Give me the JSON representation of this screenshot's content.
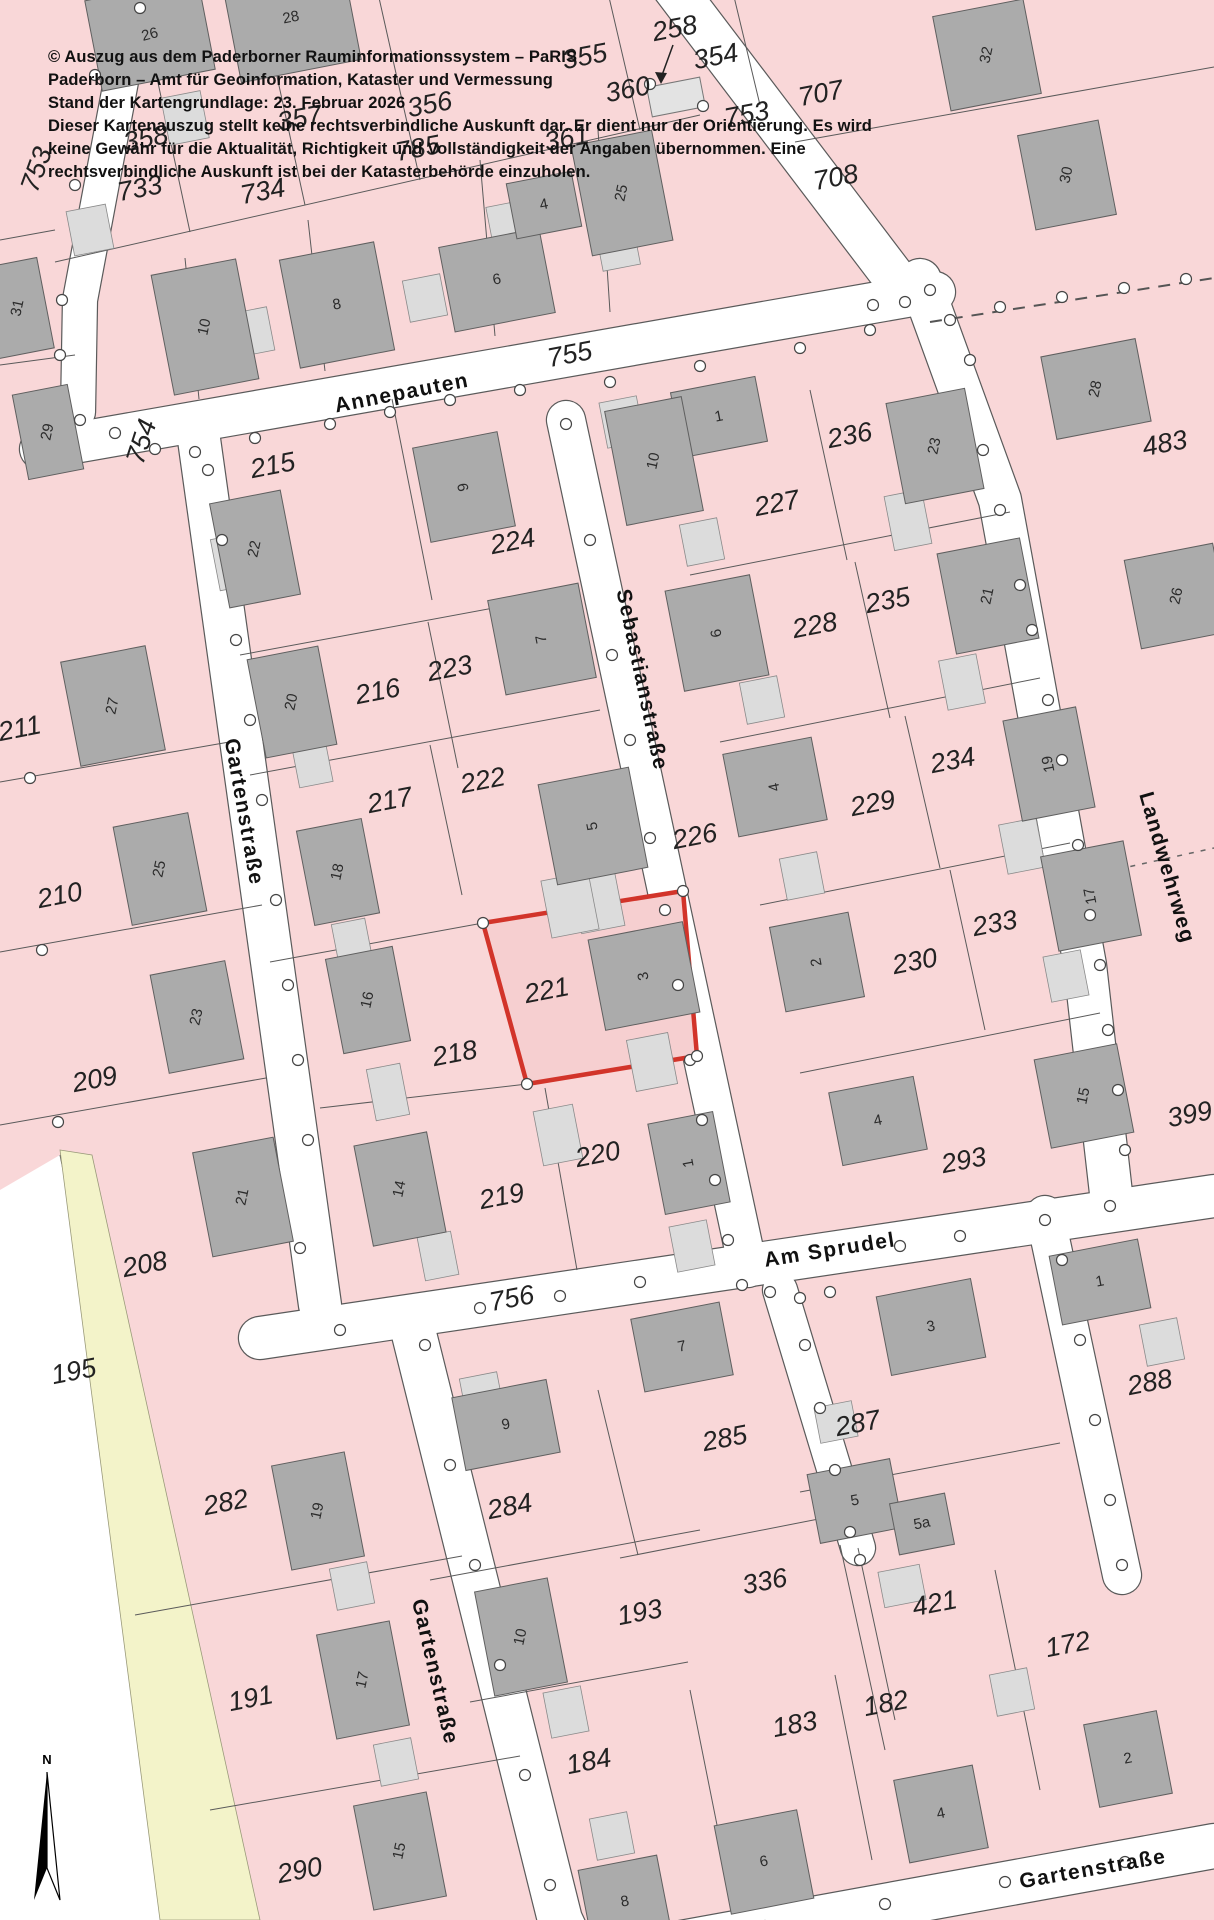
{
  "header": {
    "lines": [
      "© Auszug aus dem Paderborner Rauminformationssystem – PaRIS",
      "Paderborn – Amt für Geoinformation, Kataster und Vermessung",
      "Stand der Kartengrundlage: 23. Februar 2026",
      "Dieser Kartenauszug stellt keine rechtsverbindliche Auskunft dar. Er dient nur der Orientierung. Es wird",
      "keine Gewähr für die Aktualität, Richtigkeit und Vollständigkeit der Angaben übernommen. Eine",
      "rechtsverbindliche Auskunft ist bei der Katasterbehörde einzuholen."
    ]
  },
  "map": {
    "colors": {
      "parcel_fill": "#f9d7d8",
      "highlight_fill": "#f6cfd0",
      "highlight_stroke": "#d2342a",
      "building_fill": "#ababab",
      "annex_fill": "#dcdcdc",
      "street_fill": "#ffffff",
      "green_strip": "#f3f3c9",
      "line": "#5a5a5a"
    },
    "highlight": {
      "parcel": "221"
    },
    "north_label": "N",
    "streets": [
      {
        "name": "Annepauten",
        "x": 402,
        "y": 394,
        "rot": -11
      },
      {
        "name": "Sebastianstraße",
        "x": 641,
        "y": 680,
        "rot": 78
      },
      {
        "name": "Gartenstraße",
        "x": 243,
        "y": 812,
        "rot": 80
      },
      {
        "name": "Landwehrweg",
        "x": 1166,
        "y": 868,
        "rot": 74
      },
      {
        "name": "Am Sprudel",
        "x": 830,
        "y": 1251,
        "rot": -9
      },
      {
        "name": "Gartenstraße",
        "x": 434,
        "y": 1672,
        "rot": 77
      },
      {
        "name": "Gartenstraße",
        "x": 1093,
        "y": 1870,
        "rot": -10
      }
    ],
    "parcels": [
      {
        "n": "358",
        "x": 146,
        "y": 140
      },
      {
        "n": "357",
        "x": 300,
        "y": 120
      },
      {
        "n": "356",
        "x": 430,
        "y": 106
      },
      {
        "n": "355",
        "x": 585,
        "y": 58
      },
      {
        "n": "354",
        "x": 716,
        "y": 58
      },
      {
        "n": "258",
        "x": 675,
        "y": 30
      },
      {
        "n": "360",
        "x": 628,
        "y": 91
      },
      {
        "n": "361",
        "x": 567,
        "y": 140
      },
      {
        "n": "785",
        "x": 418,
        "y": 150
      },
      {
        "n": "733",
        "x": 140,
        "y": 190
      },
      {
        "n": "734",
        "x": 263,
        "y": 193
      },
      {
        "n": "707",
        "x": 821,
        "y": 95
      },
      {
        "n": "708",
        "x": 836,
        "y": 179
      },
      {
        "n": "753",
        "x": 747,
        "y": 116
      },
      {
        "n": "753",
        "x": 38,
        "y": 170,
        "rot": -70
      },
      {
        "n": "483",
        "x": 1165,
        "y": 445
      },
      {
        "n": "755",
        "x": 570,
        "y": 356
      },
      {
        "n": "236",
        "x": 850,
        "y": 437
      },
      {
        "n": "227",
        "x": 777,
        "y": 505
      },
      {
        "n": "215",
        "x": 273,
        "y": 467
      },
      {
        "n": "224",
        "x": 513,
        "y": 543
      },
      {
        "n": "754",
        "x": 143,
        "y": 442,
        "rot": -72
      },
      {
        "n": "216",
        "x": 378,
        "y": 693
      },
      {
        "n": "223",
        "x": 450,
        "y": 670
      },
      {
        "n": "222",
        "x": 483,
        "y": 782
      },
      {
        "n": "217",
        "x": 390,
        "y": 802
      },
      {
        "n": "226",
        "x": 695,
        "y": 838
      },
      {
        "n": "228",
        "x": 815,
        "y": 627
      },
      {
        "n": "235",
        "x": 888,
        "y": 602
      },
      {
        "n": "234",
        "x": 953,
        "y": 762
      },
      {
        "n": "229",
        "x": 873,
        "y": 805
      },
      {
        "n": "233",
        "x": 995,
        "y": 925
      },
      {
        "n": "230",
        "x": 915,
        "y": 963
      },
      {
        "n": "211",
        "x": 20,
        "y": 730
      },
      {
        "n": "210",
        "x": 60,
        "y": 897
      },
      {
        "n": "209",
        "x": 95,
        "y": 1081
      },
      {
        "n": "208",
        "x": 145,
        "y": 1266
      },
      {
        "n": "195",
        "x": 74,
        "y": 1373
      },
      {
        "n": "218",
        "x": 455,
        "y": 1055
      },
      {
        "n": "221",
        "x": 547,
        "y": 992
      },
      {
        "n": "219",
        "x": 502,
        "y": 1198
      },
      {
        "n": "220",
        "x": 598,
        "y": 1156
      },
      {
        "n": "756",
        "x": 512,
        "y": 1300
      },
      {
        "n": "293",
        "x": 964,
        "y": 1162
      },
      {
        "n": "399",
        "x": 1190,
        "y": 1116
      },
      {
        "n": "288",
        "x": 1150,
        "y": 1384
      },
      {
        "n": "287",
        "x": 858,
        "y": 1425
      },
      {
        "n": "285",
        "x": 725,
        "y": 1440
      },
      {
        "n": "282",
        "x": 226,
        "y": 1504
      },
      {
        "n": "284",
        "x": 510,
        "y": 1508
      },
      {
        "n": "336",
        "x": 765,
        "y": 1583
      },
      {
        "n": "421",
        "x": 935,
        "y": 1605
      },
      {
        "n": "172",
        "x": 1068,
        "y": 1646
      },
      {
        "n": "193",
        "x": 640,
        "y": 1614
      },
      {
        "n": "191",
        "x": 251,
        "y": 1700
      },
      {
        "n": "182",
        "x": 886,
        "y": 1705
      },
      {
        "n": "183",
        "x": 795,
        "y": 1726
      },
      {
        "n": "184",
        "x": 589,
        "y": 1763
      },
      {
        "n": "290",
        "x": 300,
        "y": 1872
      }
    ],
    "buildings": [
      {
        "n": "26",
        "x": 150,
        "y": 35,
        "rot": -15
      },
      {
        "n": "28",
        "x": 291,
        "y": 18,
        "rot": -11
      },
      {
        "n": "10",
        "x": 205,
        "y": 327,
        "rot": -78
      },
      {
        "n": "8",
        "x": 337,
        "y": 305,
        "rot": -11
      },
      {
        "n": "6",
        "x": 497,
        "y": 280,
        "rot": -11
      },
      {
        "n": "4",
        "x": 544,
        "y": 205,
        "rot": -11
      },
      {
        "n": "25",
        "x": 622,
        "y": 193,
        "rot": -78
      },
      {
        "n": "32",
        "x": 987,
        "y": 55,
        "rot": -78
      },
      {
        "n": "30",
        "x": 1067,
        "y": 175,
        "rot": -78
      },
      {
        "n": "31",
        "x": 18,
        "y": 308,
        "rot": -78
      },
      {
        "n": "29",
        "x": 48,
        "y": 432,
        "rot": -78
      },
      {
        "n": "27",
        "x": 113,
        "y": 706,
        "rot": -78
      },
      {
        "n": "25",
        "x": 160,
        "y": 869,
        "rot": -78
      },
      {
        "n": "23",
        "x": 197,
        "y": 1017,
        "rot": -78
      },
      {
        "n": "21",
        "x": 243,
        "y": 1197,
        "rot": -78
      },
      {
        "n": "22",
        "x": 255,
        "y": 549,
        "rot": -78
      },
      {
        "n": "20",
        "x": 292,
        "y": 702,
        "rot": -78
      },
      {
        "n": "18",
        "x": 338,
        "y": 872,
        "rot": -78
      },
      {
        "n": "16",
        "x": 368,
        "y": 1000,
        "rot": -78
      },
      {
        "n": "14",
        "x": 400,
        "y": 1189,
        "rot": -78
      },
      {
        "n": "9",
        "x": 464,
        "y": 487,
        "rot": -101
      },
      {
        "n": "7",
        "x": 542,
        "y": 639,
        "rot": -101
      },
      {
        "n": "5",
        "x": 593,
        "y": 826,
        "rot": -101
      },
      {
        "n": "3",
        "x": 644,
        "y": 976,
        "rot": -101
      },
      {
        "n": "1",
        "x": 689,
        "y": 1163,
        "rot": -101
      },
      {
        "n": "1",
        "x": 719,
        "y": 417,
        "rot": -11
      },
      {
        "n": "10",
        "x": 654,
        "y": 461,
        "rot": -78
      },
      {
        "n": "6",
        "x": 717,
        "y": 633,
        "rot": -101
      },
      {
        "n": "4",
        "x": 775,
        "y": 787,
        "rot": -101
      },
      {
        "n": "2",
        "x": 817,
        "y": 962,
        "rot": -101
      },
      {
        "n": "23",
        "x": 935,
        "y": 446,
        "rot": -78
      },
      {
        "n": "21",
        "x": 988,
        "y": 596,
        "rot": -78
      },
      {
        "n": "19",
        "x": 1049,
        "y": 764,
        "rot": -101
      },
      {
        "n": "17",
        "x": 1091,
        "y": 896,
        "rot": -101
      },
      {
        "n": "28",
        "x": 1096,
        "y": 389,
        "rot": -78
      },
      {
        "n": "26",
        "x": 1177,
        "y": 596,
        "rot": -78
      },
      {
        "n": "15",
        "x": 1084,
        "y": 1096,
        "rot": -78
      },
      {
        "n": "4",
        "x": 878,
        "y": 1121,
        "rot": -11
      },
      {
        "n": "7",
        "x": 682,
        "y": 1347,
        "rot": -11
      },
      {
        "n": "3",
        "x": 931,
        "y": 1327,
        "rot": -11
      },
      {
        "n": "1",
        "x": 1100,
        "y": 1282,
        "rot": -11
      },
      {
        "n": "9",
        "x": 506,
        "y": 1425,
        "rot": -11
      },
      {
        "n": "19",
        "x": 318,
        "y": 1511,
        "rot": -78
      },
      {
        "n": "17",
        "x": 363,
        "y": 1680,
        "rot": -78
      },
      {
        "n": "15",
        "x": 400,
        "y": 1851,
        "rot": -78
      },
      {
        "n": "10",
        "x": 521,
        "y": 1637,
        "rot": -78
      },
      {
        "n": "8",
        "x": 625,
        "y": 1902,
        "rot": -11
      },
      {
        "n": "6",
        "x": 764,
        "y": 1862,
        "rot": -11
      },
      {
        "n": "4",
        "x": 941,
        "y": 1814,
        "rot": -11
      },
      {
        "n": "5",
        "x": 855,
        "y": 1501,
        "rot": -11
      },
      {
        "n": "5a",
        "x": 922,
        "y": 1524,
        "rot": -11
      },
      {
        "n": "2",
        "x": 1128,
        "y": 1759,
        "rot": -11
      }
    ]
  }
}
